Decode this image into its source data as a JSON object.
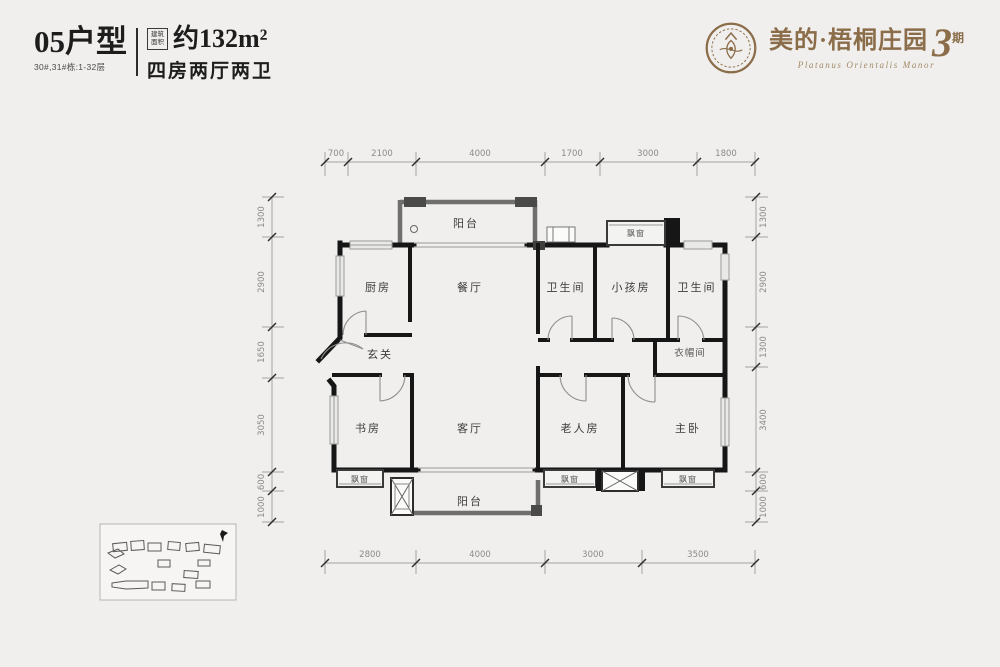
{
  "header": {
    "unit_code": "05户型",
    "unit_buildings": "30#,31#栋:1-32层",
    "area_badge": {
      "top": "建筑",
      "bottom": "面积"
    },
    "area_value": "约132m²",
    "rooms_summary": "四房两厅两卫"
  },
  "brand": {
    "name": "美的·梧桐庄园",
    "phase_number": "3",
    "phase_suffix": "期",
    "name_en": "Platanus Orientalis Manor",
    "color": "#8b6d4a"
  },
  "floorplan": {
    "room_labels": {
      "balcony_top": "阳台",
      "kitchen": "厨房",
      "dining": "餐厅",
      "bath1": "卫生间",
      "kids_room": "小孩房",
      "bath2": "卫生间",
      "foyer": "玄关",
      "cloakroom": "衣帽间",
      "study": "书房",
      "living": "客厅",
      "elder_room": "老人房",
      "master": "主卧",
      "balcony_bottom": "阳台",
      "bay": "飘窗"
    },
    "dimensions": {
      "top": [
        "700",
        "2100",
        "4000",
        "1700",
        "3000",
        "1800"
      ],
      "bottom": [
        "2800",
        "4000",
        "3000",
        "3500"
      ],
      "left": [
        "1300",
        "2900",
        "1650",
        "3050",
        "600",
        "1000"
      ],
      "right": [
        "1300",
        "2900",
        "1300",
        "3400",
        "600",
        "1000"
      ]
    }
  }
}
